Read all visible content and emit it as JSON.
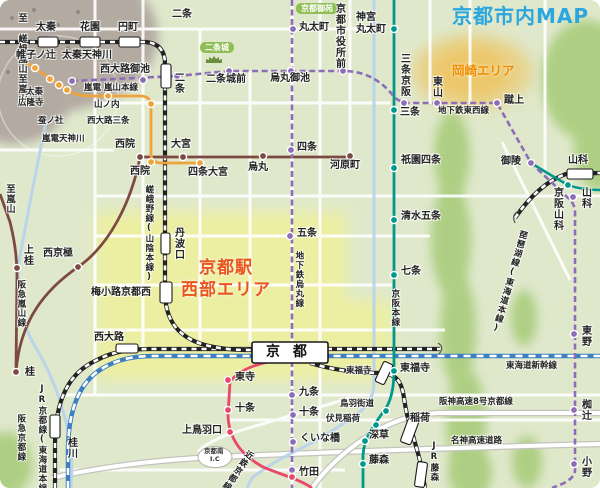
{
  "map_title": "京都市内MAP",
  "colors": {
    "background": "#dfe8cb",
    "hill_green": "#aecf83",
    "mountain_grey": "#b3aba2",
    "highlight_yellow": "#edf0a0",
    "okazaki_glow": "#f3b93f",
    "title_blue": "#2ba6de",
    "area_orange": "#f08c00",
    "area_red": "#ea5520",
    "jr_black": "#222222",
    "shinkansen_blue": "#3e7fc1",
    "subway_purple": "#8d6cb8",
    "hankyu_brown": "#7d4a42",
    "randen_orange": "#efa33c",
    "keihan_teal": "#00988c",
    "kintetsu_red": "#e8486b",
    "river_blue": "#b7d3ea",
    "pill_green": "#8fbe55"
  },
  "labels": [
    {
      "id": "map-title",
      "t": "京都市内MAP",
      "x": 452,
      "y": 6,
      "cls": "title"
    },
    {
      "id": "area-okazaki",
      "t": "岡崎エリア",
      "x": 452,
      "y": 64,
      "cls": "okazaki"
    },
    {
      "id": "area-kyoto-west-1",
      "t": "京都駅",
      "x": 199,
      "y": 260,
      "cls": "west"
    },
    {
      "id": "area-kyoto-west-2",
      "t": "西部エリア",
      "x": 181,
      "y": 282,
      "cls": "west"
    },
    {
      "id": "pill-kyoto-gyoen",
      "t": "京都御苑",
      "x": 296,
      "y": 3,
      "cls": "pill"
    },
    {
      "id": "pill-nijo-castle",
      "t": "二条城",
      "x": 200,
      "y": 42,
      "cls": "pill"
    },
    {
      "id": "dir-saga-arashiyama",
      "t": "至 嵯峨嵐山",
      "x": 16,
      "y": 13,
      "cls": "v dir"
    },
    {
      "id": "dir-arashiyama-randen",
      "t": "至嵐山",
      "x": 16,
      "y": 74,
      "cls": "v dir"
    },
    {
      "id": "dir-arashiyama-hankyu",
      "t": "至嵐山",
      "x": 4,
      "y": 184,
      "cls": "v dir"
    },
    {
      "id": "st-uzumasa",
      "t": "太秦",
      "x": 36,
      "y": 23
    },
    {
      "id": "st-hanazono",
      "t": "花園",
      "x": 80,
      "y": 23
    },
    {
      "id": "st-enmachi",
      "t": "円町",
      "x": 118,
      "y": 23
    },
    {
      "id": "st-nijo-jr",
      "t": "二条",
      "x": 172,
      "y": 10
    },
    {
      "id": "st-tambaguchi",
      "t": "丹波口",
      "x": 172,
      "y": 227,
      "cls": "v"
    },
    {
      "id": "st-umekoji-kyotonishi",
      "t": "梅小路京都西",
      "x": 91,
      "y": 288
    },
    {
      "id": "st-nishioji",
      "t": "西大路",
      "x": 94,
      "y": 333
    },
    {
      "id": "st-katsuragawa",
      "t": "桂川",
      "x": 65,
      "y": 437,
      "cls": "v"
    },
    {
      "id": "st-yamashina-jr",
      "t": "山科",
      "x": 568,
      "y": 156
    },
    {
      "id": "st-tofukuji-jr",
      "t": "東福寺",
      "x": 346,
      "y": 367,
      "cls": "s"
    },
    {
      "id": "st-inari",
      "t": "稲荷",
      "x": 410,
      "y": 414
    },
    {
      "id": "st-jr-fujinomori",
      "t": "JR藤森",
      "x": 429,
      "y": 441,
      "cls": "v s"
    },
    {
      "id": "st-marutamachi",
      "t": "丸太町",
      "x": 299,
      "y": 23
    },
    {
      "id": "st-karasuma-oike",
      "t": "烏丸御池",
      "x": 270,
      "y": 74
    },
    {
      "id": "st-shijo-subway",
      "t": "四条",
      "x": 297,
      "y": 143
    },
    {
      "id": "st-gojo-subway",
      "t": "五条",
      "x": 297,
      "y": 229
    },
    {
      "id": "st-kujo",
      "t": "九条",
      "x": 299,
      "y": 388
    },
    {
      "id": "st-jujo-subway",
      "t": "十条",
      "x": 299,
      "y": 408
    },
    {
      "id": "st-kuinabashi",
      "t": "くいな橋",
      "x": 300,
      "y": 434
    },
    {
      "id": "st-takeda",
      "t": "竹田",
      "x": 299,
      "y": 468
    },
    {
      "id": "st-uzumasa-tenjingawa",
      "t": "太秦天神川",
      "x": 62,
      "y": 51
    },
    {
      "id": "st-nishioji-oike",
      "t": "西大路御池",
      "x": 100,
      "y": 65
    },
    {
      "id": "st-nijo-subway",
      "t": "二条",
      "x": 172,
      "y": 72,
      "cls": "v"
    },
    {
      "id": "st-nijojo-mae",
      "t": "二条城前",
      "x": 206,
      "y": 75
    },
    {
      "id": "st-shiyakusho-mae",
      "t": "京都市役所前",
      "x": 333,
      "y": 3,
      "cls": "v"
    },
    {
      "id": "st-sanjo-keihan-subway",
      "t": "三条京阪",
      "x": 398,
      "y": 53,
      "cls": "v"
    },
    {
      "id": "st-higashiyama",
      "t": "東山",
      "x": 430,
      "y": 76,
      "cls": "v"
    },
    {
      "id": "st-keage",
      "t": "蹴上",
      "x": 504,
      "y": 96
    },
    {
      "id": "st-misasagi",
      "t": "御陵",
      "x": 501,
      "y": 157
    },
    {
      "id": "st-yamashina-subway",
      "t": "山科",
      "x": 579,
      "y": 187,
      "cls": "v"
    },
    {
      "id": "st-higashino",
      "t": "東野",
      "x": 579,
      "y": 325,
      "cls": "v"
    },
    {
      "id": "st-nagitsuji",
      "t": "椥辻",
      "x": 579,
      "y": 399,
      "cls": "v"
    },
    {
      "id": "st-ono",
      "t": "小野",
      "x": 579,
      "y": 456,
      "cls": "v"
    },
    {
      "id": "st-jingu-marutamachi-1",
      "t": "神宮",
      "x": 356,
      "y": 13
    },
    {
      "id": "st-jingu-marutamachi-2",
      "t": "丸太町",
      "x": 356,
      "y": 25
    },
    {
      "id": "st-sanjo",
      "t": "三条",
      "x": 400,
      "y": 108
    },
    {
      "id": "st-gion-shijo",
      "t": "祇園四条",
      "x": 401,
      "y": 156
    },
    {
      "id": "st-kiyomizu-gojo",
      "t": "清水五条",
      "x": 401,
      "y": 212
    },
    {
      "id": "st-shichijo",
      "t": "七条",
      "x": 401,
      "y": 267
    },
    {
      "id": "st-tofukuji-keihan",
      "t": "東福寺",
      "x": 400,
      "y": 364
    },
    {
      "id": "st-tobakaido",
      "t": "鳥羽街道",
      "x": 340,
      "y": 400,
      "cls": "s"
    },
    {
      "id": "st-fushimi-inari",
      "t": "伏見稲荷",
      "x": 326,
      "y": 415,
      "cls": "s"
    },
    {
      "id": "st-fukakusa",
      "t": "深草",
      "x": 369,
      "y": 431
    },
    {
      "id": "st-fujinomori",
      "t": "藤森",
      "x": 369,
      "y": 456
    },
    {
      "id": "st-katsura",
      "t": "桂",
      "x": 25,
      "y": 368
    },
    {
      "id": "st-kamikatsura",
      "t": "上桂",
      "x": 21,
      "y": 244,
      "cls": "v"
    },
    {
      "id": "st-nishi-kyogoku",
      "t": "西京極",
      "x": 43,
      "y": 249
    },
    {
      "id": "st-saiin-hankyu",
      "t": "西院",
      "x": 115,
      "y": 140
    },
    {
      "id": "st-omiya",
      "t": "大宮",
      "x": 171,
      "y": 140
    },
    {
      "id": "st-karasuma-hankyu",
      "t": "烏丸",
      "x": 248,
      "y": 163
    },
    {
      "id": "st-kawaramachi",
      "t": "河原町",
      "x": 330,
      "y": 161
    },
    {
      "id": "st-katabiranotsuji",
      "t": "帷子ノ辻",
      "x": 16,
      "y": 51
    },
    {
      "id": "st-uzumasa-koryuji-1",
      "t": "太秦",
      "x": 26,
      "y": 88,
      "cls": "s"
    },
    {
      "id": "st-uzumasa-koryuji-2",
      "t": "広隆寺",
      "x": 18,
      "y": 99,
      "cls": "s"
    },
    {
      "id": "st-kaikonoyashiro",
      "t": "蚕ノ社",
      "x": 38,
      "y": 117,
      "cls": "s"
    },
    {
      "id": "st-randen-tenjingawa",
      "t": "嵐電天神川",
      "x": 42,
      "y": 135,
      "cls": "s"
    },
    {
      "id": "st-yamanouchi",
      "t": "山ノ内",
      "x": 94,
      "y": 101,
      "cls": "s"
    },
    {
      "id": "st-nishioji-sanjo",
      "t": "西大路三条",
      "x": 87,
      "y": 117,
      "cls": "s"
    },
    {
      "id": "st-saiin-randen",
      "t": "西院",
      "x": 130,
      "y": 167
    },
    {
      "id": "st-shijo-omiya",
      "t": "四条大宮",
      "x": 188,
      "y": 168
    },
    {
      "id": "st-toji",
      "t": "東寺",
      "x": 235,
      "y": 373
    },
    {
      "id": "st-jujo-kintetsu",
      "t": "十条",
      "x": 235,
      "y": 404
    },
    {
      "id": "st-kamitobaguchi",
      "t": "上鳥羽口",
      "x": 182,
      "y": 426
    },
    {
      "id": "st-kyoto",
      "t": "京 都",
      "x": 266,
      "y": 345,
      "cls": "kyoto"
    },
    {
      "id": "line-randen-arashiyama",
      "t": "嵐電 嵐山本線",
      "x": 84,
      "y": 84,
      "cls": "line"
    },
    {
      "id": "line-subway-tozai",
      "t": "地下鉄東西線",
      "x": 438,
      "y": 107,
      "cls": "line"
    },
    {
      "id": "line-subway-karasuma",
      "t": "地下鉄烏丸線",
      "x": 294,
      "y": 251,
      "cls": "v line"
    },
    {
      "id": "line-sagano",
      "t": "嵯峨野線(山陰本線)",
      "x": 144,
      "y": 185,
      "cls": "v line"
    },
    {
      "id": "line-keihan-main",
      "t": "京阪本線",
      "x": 390,
      "y": 289,
      "cls": "v line"
    },
    {
      "id": "line-hankyu-kyoto",
      "t": "阪急京都線",
      "x": 16,
      "y": 414,
      "cls": "v line"
    },
    {
      "id": "line-hankyu-arashiyama",
      "t": "阪急嵐山線",
      "x": 16,
      "y": 280,
      "cls": "v line"
    },
    {
      "id": "line-jr-kyoto",
      "t": "JR京都線(東海道本線)",
      "x": 37,
      "y": 384,
      "cls": "v line"
    },
    {
      "id": "line-kintetsu-kyoto",
      "t": "近鉄京都線",
      "x": 247,
      "y": 448,
      "cls": "v line",
      "rot": 35
    },
    {
      "id": "line-biwako",
      "t": "琵琶湖線(東海道本線)",
      "x": 519,
      "y": 229,
      "cls": "v line",
      "rot": 16
    },
    {
      "id": "line-tokaido-shinkansen",
      "t": "東海道新幹線",
      "x": 506,
      "y": 362,
      "cls": "line"
    },
    {
      "id": "hwy-hanshin-8-kyoto",
      "t": "阪神高速8号京都線",
      "x": 439,
      "y": 398,
      "cls": "line"
    },
    {
      "id": "hwy-meishin",
      "t": "名神高速道路",
      "x": 451,
      "y": 437,
      "cls": "line"
    },
    {
      "id": "ic-kyoto-minami-1",
      "t": "京都南",
      "x": 204,
      "y": 448,
      "cls": "ic"
    },
    {
      "id": "ic-kyoto-minami-2",
      "t": "I.C",
      "x": 210,
      "y": 456,
      "cls": "ic"
    },
    {
      "id": "st-keihan-yamashina",
      "t": "京阪山科",
      "x": 551,
      "y": 187,
      "cls": "v"
    }
  ],
  "stations": [
    {
      "id": "uzumasa-tenjingawa",
      "line": "subway",
      "x": 72,
      "y": 81
    },
    {
      "id": "nishioji-oike",
      "line": "subway",
      "x": 143,
      "y": 80
    },
    {
      "id": "nijo-subway",
      "line": "subway",
      "x": 177,
      "y": 76
    },
    {
      "id": "nijojo-mae",
      "line": "subway",
      "x": 229,
      "y": 71
    },
    {
      "id": "karasuma-oike",
      "line": "subway",
      "x": 291,
      "y": 71
    },
    {
      "id": "shiyakusho-mae",
      "line": "subway",
      "x": 343,
      "y": 71
    },
    {
      "id": "sanjo-keihan-subway",
      "line": "subway",
      "x": 404,
      "y": 103
    },
    {
      "id": "higashiyama",
      "line": "subway",
      "x": 437,
      "y": 103
    },
    {
      "id": "keage",
      "line": "subway",
      "x": 497,
      "y": 103
    },
    {
      "id": "misasagi",
      "line": "subway",
      "x": 531,
      "y": 163
    },
    {
      "id": "yamashina-subway",
      "line": "subway",
      "x": 573,
      "y": 197
    },
    {
      "id": "higashino",
      "line": "subway",
      "x": 574,
      "y": 334
    },
    {
      "id": "nagitsuji",
      "line": "subway",
      "x": 574,
      "y": 410
    },
    {
      "id": "ono",
      "line": "subway",
      "x": 574,
      "y": 464
    },
    {
      "id": "marutamachi",
      "line": "subway",
      "x": 293,
      "y": 29
    },
    {
      "id": "shijo-subway",
      "line": "subway",
      "x": 291,
      "y": 150
    },
    {
      "id": "gojo-subway",
      "line": "subway",
      "x": 290,
      "y": 236
    },
    {
      "id": "kujo",
      "line": "subway",
      "x": 292,
      "y": 395
    },
    {
      "id": "jujo-subway",
      "line": "subway",
      "x": 293,
      "y": 415
    },
    {
      "id": "kuinabashi",
      "line": "subway",
      "x": 293,
      "y": 442
    },
    {
      "id": "takeda-subway",
      "line": "subway",
      "x": 292,
      "y": 470
    },
    {
      "id": "jingu-marutamachi",
      "line": "keihan",
      "x": 394,
      "y": 29
    },
    {
      "id": "sanjo",
      "line": "keihan",
      "x": 394,
      "y": 110
    },
    {
      "id": "gion-shijo",
      "line": "keihan",
      "x": 394,
      "y": 168
    },
    {
      "id": "kiyomizu-gojo",
      "line": "keihan",
      "x": 394,
      "y": 220
    },
    {
      "id": "shichijo",
      "line": "keihan",
      "x": 394,
      "y": 275
    },
    {
      "id": "tofukuji-keihan",
      "line": "keihan",
      "x": 394,
      "y": 371
    },
    {
      "id": "tobakaido",
      "line": "keihan",
      "x": 386,
      "y": 411
    },
    {
      "id": "fushimi-inari",
      "line": "keihan",
      "x": 376,
      "y": 425
    },
    {
      "id": "fukakusa",
      "line": "keihan",
      "x": 365,
      "y": 441
    },
    {
      "id": "fujinomori",
      "line": "keihan",
      "x": 363,
      "y": 464
    },
    {
      "id": "keihan-yamashina",
      "line": "keihan",
      "x": 568,
      "y": 185
    },
    {
      "id": "katsura",
      "line": "hankyu",
      "x": 16,
      "y": 372
    },
    {
      "id": "kamikatsura",
      "line": "hankyu",
      "x": 17,
      "y": 268
    },
    {
      "id": "nishi-kyogoku",
      "line": "hankyu",
      "x": 78,
      "y": 267
    },
    {
      "id": "saiin-hankyu",
      "line": "hankyu",
      "x": 140,
      "y": 157
    },
    {
      "id": "omiya",
      "line": "hankyu",
      "x": 183,
      "y": 157
    },
    {
      "id": "karasuma-hankyu",
      "line": "hankyu",
      "x": 263,
      "y": 156
    },
    {
      "id": "kawaramachi",
      "line": "hankyu",
      "x": 350,
      "y": 156
    },
    {
      "id": "katabiranotsuji",
      "line": "randen",
      "x": 35,
      "y": 68
    },
    {
      "id": "uzumasa-koryuji",
      "line": "randen",
      "x": 50,
      "y": 79
    },
    {
      "id": "kaikonoyashiro",
      "line": "randen",
      "x": 59,
      "y": 85
    },
    {
      "id": "randen-tenjingawa",
      "line": "randen",
      "x": 67,
      "y": 90
    },
    {
      "id": "yamanouchi",
      "line": "randen",
      "x": 108,
      "y": 96
    },
    {
      "id": "nishioji-sanjo",
      "line": "randen",
      "x": 151,
      "y": 104
    },
    {
      "id": "saiin-randen",
      "line": "randen",
      "x": 151,
      "y": 162
    },
    {
      "id": "shijo-omiya",
      "line": "randen",
      "x": 200,
      "y": 163
    },
    {
      "id": "toji",
      "line": "kintetsu",
      "x": 228,
      "y": 380
    },
    {
      "id": "jujo-kintetsu",
      "line": "kintetsu",
      "x": 228,
      "y": 410
    },
    {
      "id": "kamitobaguchi",
      "line": "kintetsu",
      "x": 230,
      "y": 432
    },
    {
      "id": "takeda-kintetsu",
      "line": "kintetsu",
      "x": 292,
      "y": 477
    }
  ],
  "jr_station_boxes": [
    {
      "id": "uzumasa",
      "x": 38,
      "y": 37,
      "w": 20,
      "h": 10
    },
    {
      "id": "hanazono",
      "x": 80,
      "y": 37,
      "w": 20,
      "h": 10
    },
    {
      "id": "enmachi",
      "x": 119,
      "y": 37,
      "w": 21,
      "h": 10
    },
    {
      "id": "nijo",
      "x": 161,
      "y": 64,
      "w": 10,
      "h": 24
    },
    {
      "id": "tambaguchi",
      "x": 161,
      "y": 233,
      "w": 9,
      "h": 21
    },
    {
      "id": "umekoji-kyotonishi",
      "x": 160,
      "y": 282,
      "w": 12,
      "h": 21
    },
    {
      "id": "nishioji",
      "x": 116,
      "y": 344,
      "w": 22,
      "h": 9
    },
    {
      "id": "kyoto",
      "x": 252,
      "y": 342,
      "w": 76,
      "h": 21
    },
    {
      "id": "katsuragawa",
      "x": 50,
      "y": 415,
      "w": 10,
      "h": 23
    },
    {
      "id": "yamashina",
      "x": 567,
      "y": 169,
      "w": 26,
      "h": 10
    },
    {
      "id": "tofukuji-jr",
      "x": 379,
      "y": 362,
      "w": 10,
      "h": 22,
      "rot": 25
    },
    {
      "id": "inari",
      "x": 404,
      "y": 419,
      "w": 11,
      "h": 25,
      "rot": 20
    },
    {
      "id": "jr-fujinomori",
      "x": 416,
      "y": 462,
      "w": 10,
      "h": 25,
      "rot": 8
    }
  ]
}
